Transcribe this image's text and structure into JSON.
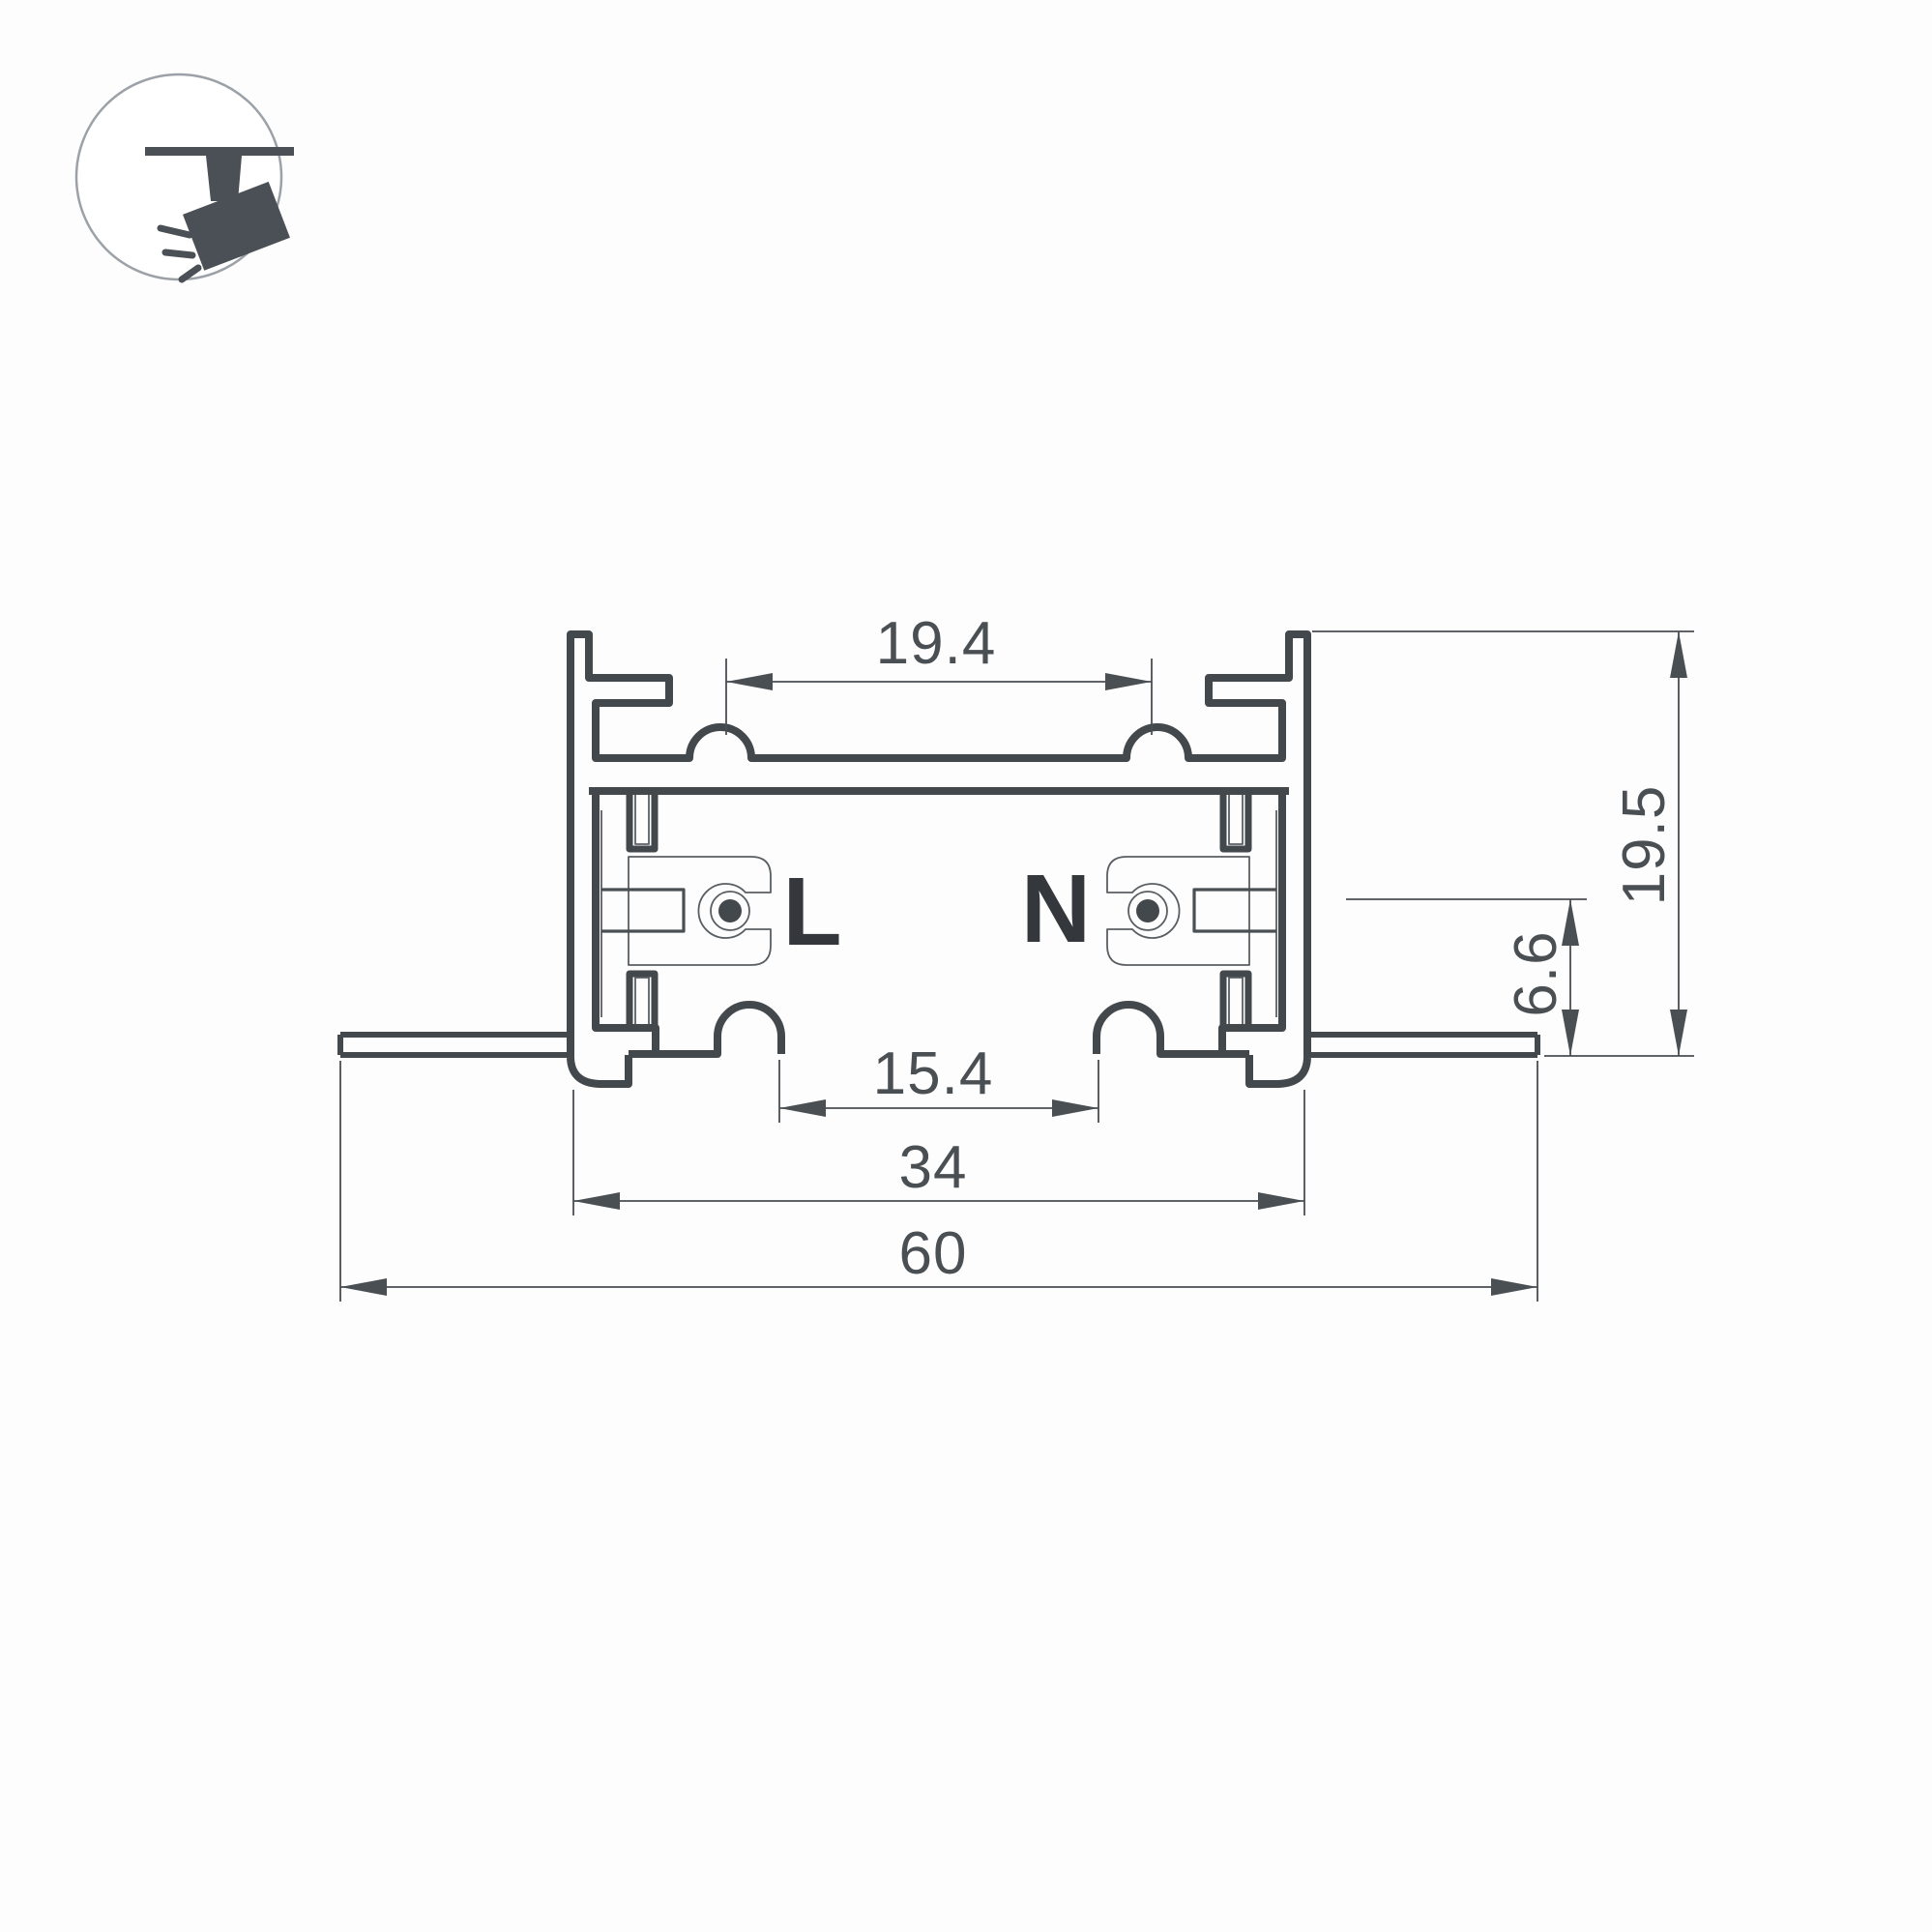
{
  "page": {
    "background": "#fdfdfd"
  },
  "logo": {
    "name": "track-spotlight-pictogram",
    "icon_color": "#4a5055",
    "ring_color": "#9ba1a6"
  },
  "drawing": {
    "stroke_color": "#43484d",
    "dim_color": "#4a4f54",
    "label_color": "#34383c",
    "conductors": {
      "line_label": "L",
      "neutral_label": "N"
    },
    "dimensions": {
      "top_inner_width": "19.4",
      "overall_height": "19.5",
      "recess_depth": "6.6",
      "opening_width": "15.4",
      "housing_width": "34",
      "overall_width": "60"
    }
  }
}
